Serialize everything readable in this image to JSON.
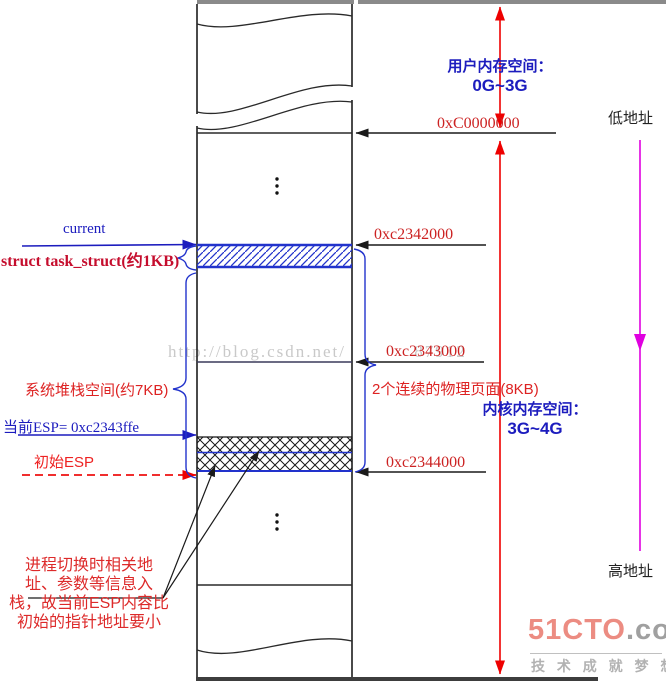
{
  "diagram": {
    "left": {
      "current": "current",
      "task_struct": "struct task_struct(约1KB)",
      "stack_space": "系统堆栈空间(约7KB)",
      "current_esp": "当前ESP= 0xc2343ffe",
      "initial_esp": "初始ESP",
      "note_lines": [
        "进程切换时相关地",
        "址、参数等信息入",
        "栈，故当前ESP内容比",
        "初始的指针地址要小"
      ]
    },
    "right": {
      "user_space_line1": "用户内存空间：",
      "user_space_line2": "0G~3G",
      "kernel_space_line1": "内核内存空间：",
      "kernel_space_line2": "3G~4G",
      "phys_pages": "2个连续的物理页面(8KB)",
      "addr_c0000000": "0xC0000000",
      "addr_c2342000": "0xc2342000",
      "addr_c2343000": "0xc2343000",
      "addr_c2344000": "0xc2344000",
      "low_addr": "低地址",
      "high_addr": "高地址"
    },
    "ellipsis": "⋮",
    "watermark": {
      "left_part": "http://blog.csdn.net/",
      "right_part": "87912"
    },
    "colors": {
      "label_blue": "#1c1cbe",
      "label_red": "#cc2222",
      "arrow_red": "#ee0000",
      "hatch_blue": "#2233cc",
      "direction_magenta": "#e000e0",
      "line_black": "#1a1a1a",
      "watermark_gray": "#c9c9c9",
      "logo_salmon": "#ec8c82",
      "logo_gray": "#a0a0a0"
    }
  },
  "branding": {
    "logo_main": "51CTO",
    "logo_suffix": ".com",
    "slogan": "技 术 成 就 梦 想"
  }
}
